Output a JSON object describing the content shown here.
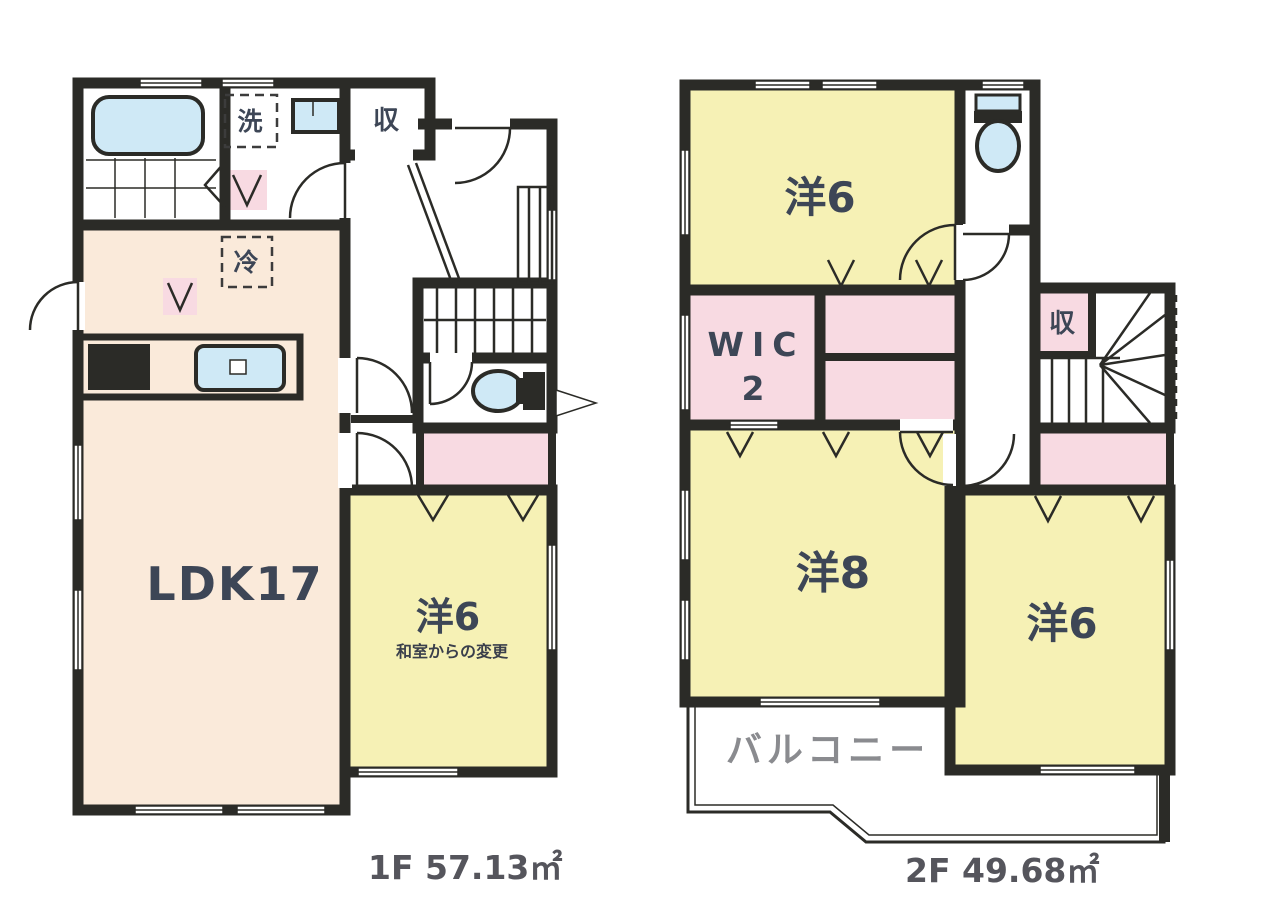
{
  "colors": {
    "wall": "#2b2b27",
    "cream": "#faeada",
    "yellow": "#f6f1b5",
    "pink": "#f8dae2",
    "blue": "#cfe9f6",
    "label": "#3d4656",
    "area_label": "#55555c",
    "balcony_label": "#8a8b8f"
  },
  "floor1": {
    "area_label": "1F 57.13㎡",
    "ldk_label": "LDK17",
    "bedroom_label": "洋6",
    "bedroom_note": "和室からの変更",
    "storage_label": "収",
    "laundry_label": "洗",
    "fridge_label": "冷"
  },
  "floor2": {
    "area_label": "2F 49.68㎡",
    "bedroom_top_label": "洋6",
    "bedroom_large_label": "洋8",
    "bedroom_right_label": "洋6",
    "wic_label": "WIC",
    "wic_size": "2",
    "storage_label": "収",
    "balcony_label": "バルコニー"
  }
}
